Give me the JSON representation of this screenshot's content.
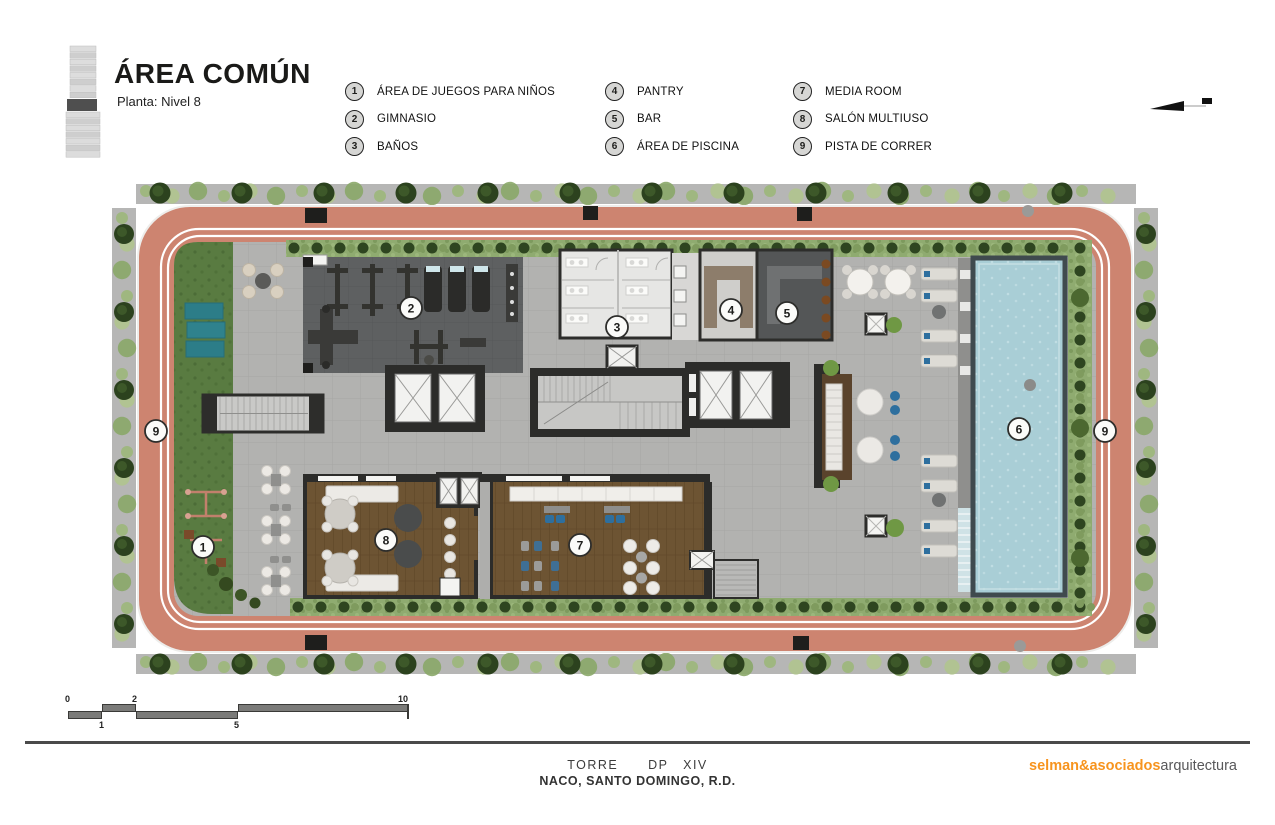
{
  "header": {
    "title": "ÁREA COMÚN",
    "subtitle": "Planta: Nivel 8"
  },
  "legend": {
    "columns": [
      {
        "x": 345,
        "items": [
          {
            "num": "1",
            "label": "ÁREA DE JUEGOS PARA NIÑOS"
          },
          {
            "num": "2",
            "label": "GIMNASIO"
          },
          {
            "num": "3",
            "label": "BAÑOS"
          }
        ]
      },
      {
        "x": 605,
        "items": [
          {
            "num": "4",
            "label": "PANTRY"
          },
          {
            "num": "5",
            "label": "BAR"
          },
          {
            "num": "6",
            "label": "ÁREA DE PISCINA"
          }
        ]
      },
      {
        "x": 793,
        "items": [
          {
            "num": "7",
            "label": "MEDIA ROOM"
          },
          {
            "num": "8",
            "label": "SALÓN MULTIUSO"
          },
          {
            "num": "9",
            "label": "PISTA DE CORRER"
          }
        ]
      }
    ]
  },
  "plan": {
    "badges": [
      {
        "num": "1",
        "x": 95,
        "y": 369
      },
      {
        "num": "2",
        "x": 303,
        "y": 130
      },
      {
        "num": "3",
        "x": 509,
        "y": 149
      },
      {
        "num": "4",
        "x": 623,
        "y": 132
      },
      {
        "num": "5",
        "x": 679,
        "y": 135
      },
      {
        "num": "6",
        "x": 911,
        "y": 251
      },
      {
        "num": "7",
        "x": 472,
        "y": 367
      },
      {
        "num": "8",
        "x": 278,
        "y": 362
      },
      {
        "num": "9",
        "x": 48,
        "y": 253
      },
      {
        "num": "9",
        "x": 997,
        "y": 253
      }
    ],
    "colors": {
      "track": "#cd8470",
      "pool": "#a9ced6",
      "lawn": "#597b41",
      "wood": "#6d5433",
      "gym": "#5e6061",
      "tile": "#b2b2b0",
      "wall": "#2c2c2a",
      "hedge": "#8fab70"
    }
  },
  "scale_bar": {
    "labels": [
      {
        "text": "0",
        "x": -3,
        "row": "top"
      },
      {
        "text": "2",
        "x": 64,
        "row": "top"
      },
      {
        "text": "10",
        "x": 330,
        "row": "top"
      },
      {
        "text": "1",
        "x": 31,
        "row": "bottom"
      },
      {
        "text": "5",
        "x": 166,
        "row": "bottom"
      }
    ]
  },
  "footer": {
    "project_line": "TORRE      DP   XIV",
    "location_line": "NACO, SANTO DOMINGO, R.D.",
    "brand_bold": "selman&asociados",
    "brand_light": "arquitectura",
    "brand_color": "#f7941e"
  }
}
